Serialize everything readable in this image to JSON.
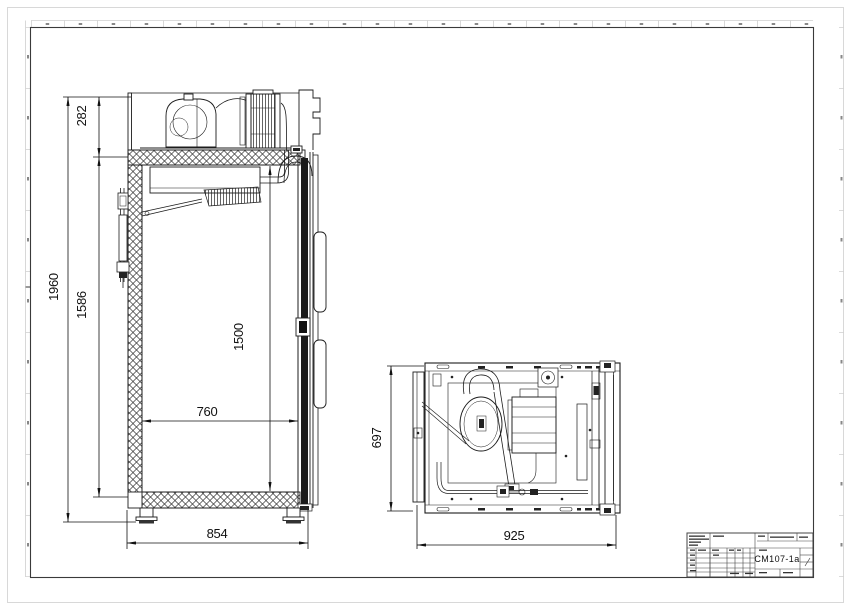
{
  "sheet": {
    "line_color": "#1c1c1c",
    "frame_color": "#3a3a3a",
    "margin_color": "#cccccc",
    "title_block": {
      "part_number": "CM107-1a"
    }
  },
  "views": {
    "side_section": {
      "dimensions": {
        "overall_height": "1960",
        "condensing_unit_height": "282",
        "body_height": "1586",
        "door_opening_height": "1500",
        "inner_width": "760",
        "overall_width": "854"
      }
    },
    "top_view": {
      "dimensions": {
        "depth": "697",
        "overall_depth": "925"
      }
    }
  }
}
